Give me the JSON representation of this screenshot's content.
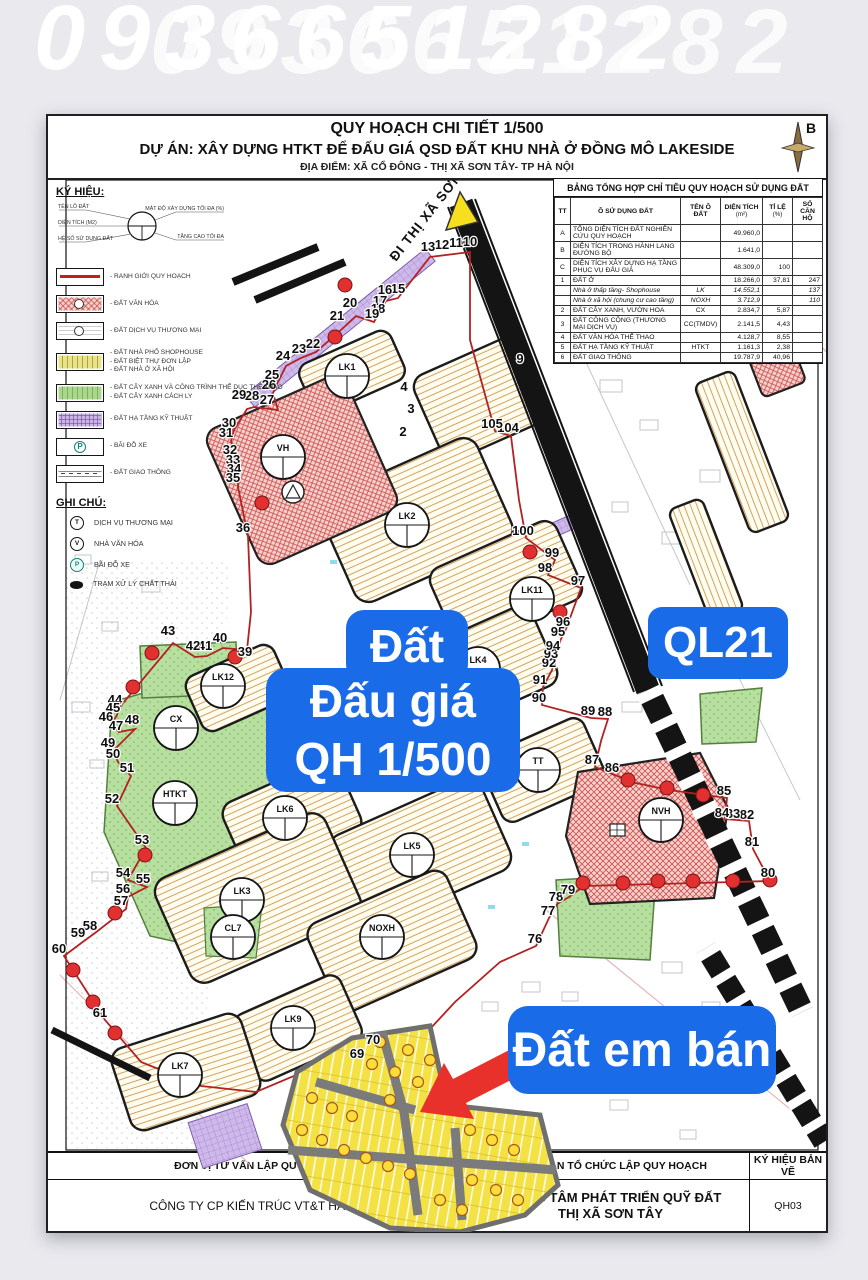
{
  "watermark": {
    "phone": "0936651282"
  },
  "header": {
    "line1": "QUY HOẠCH CHI TIẾT 1/500",
    "line2": "DỰ ÁN: XÂY DỰNG HTKT ĐỂ ĐẤU GIÁ QSD ĐẤT KHU NHÀ Ở ĐỒNG MÔ LAKESIDE",
    "line3": "ĐỊA ĐIỂM: XÃ CỔ ĐÔNG - THỊ XÃ SƠN TÂY- TP HÀ NỘI",
    "north_label": "B"
  },
  "legend": {
    "heading": "KÝ HIỆU:",
    "symbol_labels": [
      "TÊN LÔ ĐẤT",
      "DIỆN TÍCH (M2)",
      "HỆ SỐ SỬ DỤNG ĐẤT",
      "MẬT ĐỘ XÂY DỰNG TỐI ĐA (%)",
      "TẦNG CAO TỐI ĐA"
    ],
    "items": [
      {
        "type": "boundary",
        "labels": [
          "RANH GIỚI QUY HOẠCH"
        ]
      },
      {
        "type": "culture",
        "labels": [
          "ĐẤT VĂN HÓA"
        ]
      },
      {
        "type": "commerce",
        "labels": [
          "ĐẤT DỊCH VỤ THƯƠNG MẠI"
        ]
      },
      {
        "type": "housing",
        "labels": [
          "ĐẤT NHÀ PHỐ SHOPHOUSE",
          "ĐẤT BIỆT THỰ ĐƠN LẬP",
          "ĐẤT NHÀ Ở XÃ HỘI"
        ]
      },
      {
        "type": "green",
        "labels": [
          "ĐẤT CÂY XANH VÀ CÔNG TRÌNH THỂ DỤC THỂ THAO",
          "ĐẤT CÂY XANH CÁCH LY"
        ]
      },
      {
        "type": "infra",
        "labels": [
          "ĐẤT HẠ TẦNG KỸ THUẬT"
        ]
      },
      {
        "type": "parking",
        "labels": [
          "BÃI ĐỖ XE"
        ]
      },
      {
        "type": "traffic",
        "labels": [
          "ĐẤT GIAO THÔNG"
        ]
      }
    ],
    "notes_heading": "GHI CHÚ:",
    "notes": [
      {
        "icon": "commerce",
        "glyph": "T",
        "label": "DỊCH VỤ THƯƠNG MẠI"
      },
      {
        "icon": "culture",
        "glyph": "V",
        "label": "NHÀ VĂN HÓA"
      },
      {
        "icon": "parking",
        "glyph": "P",
        "label": "BÃI ĐỖ XE"
      },
      {
        "icon": "waste",
        "glyph": "",
        "label": "TRẠM XỬ LÝ CHẤT THẢI"
      }
    ]
  },
  "table": {
    "title": "BẢNG TỔNG HỢP CHỈ TIÊU QUY HOẠCH SỬ DỤNG ĐẤT",
    "columns": [
      {
        "l1": "TT"
      },
      {
        "l1": "Ô SỬ DỤNG ĐẤT"
      },
      {
        "l1": "TÊN Ô ĐẤT"
      },
      {
        "l1": "DIỆN TÍCH",
        "l2": "(m²)"
      },
      {
        "l1": "TỈ LỆ",
        "l2": "(%)"
      },
      {
        "l1": "SỐ CĂN HỘ"
      }
    ],
    "rows": [
      {
        "tt": "A",
        "name": "TỔNG DIỆN TÍCH ĐẤT NGHIÊN CỨU QUY HOẠCH",
        "code": "",
        "area": "49.960,0",
        "ratio": "",
        "units": ""
      },
      {
        "tt": "B",
        "name": "DIỆN TÍCH TRONG HÀNH LANG ĐƯỜNG BỘ",
        "code": "",
        "area": "1.641,0",
        "ratio": "",
        "units": ""
      },
      {
        "tt": "C",
        "name": "DIỆN TÍCH XÂY DỰNG HẠ TẦNG PHỤC VỤ ĐẤU GIÁ",
        "code": "",
        "area": "48.309,0",
        "ratio": "100",
        "units": ""
      },
      {
        "tt": "1",
        "name": "ĐẤT Ở",
        "code": "",
        "area": "18.266,0",
        "ratio": "37,81",
        "units": "247"
      },
      {
        "tt": "",
        "name": "Nhà ở thấp tầng- Shophouse",
        "code": "LK",
        "area": "14.552,1",
        "ratio": "",
        "units": "137",
        "italic": true
      },
      {
        "tt": "",
        "name": "Nhà ở xã hội (chung cư cao tầng)",
        "code": "NOXH",
        "area": "3.712,9",
        "ratio": "",
        "units": "110",
        "italic": true
      },
      {
        "tt": "2",
        "name": "ĐẤT CÂY XANH, VƯỜN HOA",
        "code": "CX",
        "area": "2.834,7",
        "ratio": "5,87",
        "units": ""
      },
      {
        "tt": "3",
        "name": "ĐẤT CÔNG CỘNG (THƯƠNG MẠI DỊCH VỤ)",
        "code": "CC(TMDV)",
        "area": "2.141,5",
        "ratio": "4,43",
        "units": ""
      },
      {
        "tt": "4",
        "name": "ĐẤT VĂN HÓA THỂ THAO",
        "code": "",
        "area": "4.128,7",
        "ratio": "8,55",
        "units": ""
      },
      {
        "tt": "5",
        "name": "ĐẤT HẠ TẦNG KỸ THUẬT",
        "code": "HTKT",
        "area": "1.161,3",
        "ratio": "2,38",
        "units": ""
      },
      {
        "tt": "6",
        "name": "ĐẤT GIAO THÔNG",
        "code": "",
        "area": "19.787,9",
        "ratio": "40,96",
        "units": ""
      }
    ]
  },
  "map": {
    "road_label": "ĐI THỊ XÃ SƠN TÂY",
    "overlays": {
      "auction_line1": "Đất",
      "auction_line2": "Đấu giá",
      "auction_line3": "QH 1/500",
      "highway": "QL21",
      "sale": "Đất em bán"
    },
    "boundary_points": [
      {
        "n": "2",
        "x": 403,
        "y": 436
      },
      {
        "n": "3",
        "x": 411,
        "y": 413
      },
      {
        "n": "4",
        "x": 404,
        "y": 391
      },
      {
        "n": "9",
        "x": 520,
        "y": 363
      },
      {
        "n": "10",
        "x": 470,
        "y": 246
      },
      {
        "n": "11",
        "x": 456,
        "y": 247
      },
      {
        "n": "12",
        "x": 442,
        "y": 249
      },
      {
        "n": "13",
        "x": 428,
        "y": 251
      },
      {
        "n": "15",
        "x": 398,
        "y": 293
      },
      {
        "n": "16",
        "x": 385,
        "y": 294
      },
      {
        "n": "17",
        "x": 380,
        "y": 305
      },
      {
        "n": "18",
        "x": 378,
        "y": 313
      },
      {
        "n": "19",
        "x": 372,
        "y": 318
      },
      {
        "n": "20",
        "x": 350,
        "y": 307
      },
      {
        "n": "21",
        "x": 337,
        "y": 320
      },
      {
        "n": "22",
        "x": 313,
        "y": 348
      },
      {
        "n": "23",
        "x": 299,
        "y": 353
      },
      {
        "n": "24",
        "x": 283,
        "y": 360
      },
      {
        "n": "25",
        "x": 272,
        "y": 379
      },
      {
        "n": "26",
        "x": 269,
        "y": 389
      },
      {
        "n": "27",
        "x": 267,
        "y": 404
      },
      {
        "n": "28",
        "x": 252,
        "y": 400
      },
      {
        "n": "29",
        "x": 239,
        "y": 399
      },
      {
        "n": "30",
        "x": 229,
        "y": 427
      },
      {
        "n": "31",
        "x": 226,
        "y": 437
      },
      {
        "n": "32",
        "x": 230,
        "y": 454
      },
      {
        "n": "33",
        "x": 233,
        "y": 464
      },
      {
        "n": "34",
        "x": 234,
        "y": 473
      },
      {
        "n": "35",
        "x": 233,
        "y": 482
      },
      {
        "n": "36",
        "x": 243,
        "y": 532
      },
      {
        "n": "39",
        "x": 245,
        "y": 656
      },
      {
        "n": "40",
        "x": 220,
        "y": 642
      },
      {
        "n": "41",
        "x": 205,
        "y": 650
      },
      {
        "n": "42",
        "x": 193,
        "y": 650
      },
      {
        "n": "43",
        "x": 168,
        "y": 635
      },
      {
        "n": "44",
        "x": 115,
        "y": 704
      },
      {
        "n": "45",
        "x": 113,
        "y": 712
      },
      {
        "n": "46",
        "x": 106,
        "y": 721
      },
      {
        "n": "47",
        "x": 116,
        "y": 730
      },
      {
        "n": "48",
        "x": 132,
        "y": 724
      },
      {
        "n": "49",
        "x": 108,
        "y": 747
      },
      {
        "n": "50",
        "x": 113,
        "y": 758
      },
      {
        "n": "51",
        "x": 127,
        "y": 772
      },
      {
        "n": "52",
        "x": 112,
        "y": 803
      },
      {
        "n": "53",
        "x": 142,
        "y": 844
      },
      {
        "n": "54",
        "x": 123,
        "y": 877
      },
      {
        "n": "55",
        "x": 143,
        "y": 883
      },
      {
        "n": "56",
        "x": 123,
        "y": 893
      },
      {
        "n": "57",
        "x": 121,
        "y": 905
      },
      {
        "n": "58",
        "x": 90,
        "y": 930
      },
      {
        "n": "59",
        "x": 78,
        "y": 937
      },
      {
        "n": "60",
        "x": 59,
        "y": 953
      },
      {
        "n": "61",
        "x": 100,
        "y": 1017
      },
      {
        "n": "69",
        "x": 357,
        "y": 1058
      },
      {
        "n": "70",
        "x": 373,
        "y": 1044
      },
      {
        "n": "76",
        "x": 535,
        "y": 943
      },
      {
        "n": "77",
        "x": 548,
        "y": 915
      },
      {
        "n": "78",
        "x": 556,
        "y": 901
      },
      {
        "n": "79",
        "x": 568,
        "y": 894
      },
      {
        "n": "80",
        "x": 768,
        "y": 877
      },
      {
        "n": "81",
        "x": 752,
        "y": 846
      },
      {
        "n": "82",
        "x": 747,
        "y": 819
      },
      {
        "n": "83",
        "x": 733,
        "y": 818
      },
      {
        "n": "84",
        "x": 722,
        "y": 817
      },
      {
        "n": "85",
        "x": 724,
        "y": 795
      },
      {
        "n": "86",
        "x": 612,
        "y": 772
      },
      {
        "n": "87",
        "x": 592,
        "y": 764
      },
      {
        "n": "88",
        "x": 605,
        "y": 716
      },
      {
        "n": "89",
        "x": 588,
        "y": 715
      },
      {
        "n": "90",
        "x": 539,
        "y": 702
      },
      {
        "n": "91",
        "x": 540,
        "y": 684
      },
      {
        "n": "92",
        "x": 549,
        "y": 667
      },
      {
        "n": "93",
        "x": 551,
        "y": 658
      },
      {
        "n": "94",
        "x": 553,
        "y": 650
      },
      {
        "n": "95",
        "x": 558,
        "y": 636
      },
      {
        "n": "96",
        "x": 563,
        "y": 626
      },
      {
        "n": "97",
        "x": 578,
        "y": 585
      },
      {
        "n": "98",
        "x": 545,
        "y": 572
      },
      {
        "n": "99",
        "x": 552,
        "y": 557
      },
      {
        "n": "100",
        "x": 523,
        "y": 535
      },
      {
        "n": "104",
        "x": 508,
        "y": 432
      },
      {
        "n": "105",
        "x": 492,
        "y": 428
      }
    ],
    "plot_labels": [
      {
        "label": "LK1",
        "x": 347,
        "y": 376
      },
      {
        "label": "VH",
        "x": 283,
        "y": 457
      },
      {
        "label": "LK2",
        "x": 407,
        "y": 525
      },
      {
        "label": "LK11",
        "x": 532,
        "y": 599
      },
      {
        "label": "LK4",
        "x": 478,
        "y": 669
      },
      {
        "label": "LK12",
        "x": 223,
        "y": 686
      },
      {
        "label": "CX",
        "x": 176,
        "y": 728
      },
      {
        "label": "HTKT",
        "x": 175,
        "y": 803
      },
      {
        "label": "LK6",
        "x": 285,
        "y": 818
      },
      {
        "label": "LK5",
        "x": 412,
        "y": 855
      },
      {
        "label": "TT",
        "x": 538,
        "y": 770
      },
      {
        "label": "LK3",
        "x": 242,
        "y": 900
      },
      {
        "label": "CL7",
        "x": 233,
        "y": 937
      },
      {
        "label": "NOXH",
        "x": 382,
        "y": 937
      },
      {
        "label": "LK9",
        "x": 293,
        "y": 1028
      },
      {
        "label": "LK7",
        "x": 180,
        "y": 1075
      },
      {
        "label": "NVH",
        "x": 661,
        "y": 820
      }
    ],
    "red_dots": [
      [
        345,
        285
      ],
      [
        335,
        337
      ],
      [
        262,
        503
      ],
      [
        152,
        653
      ],
      [
        235,
        657
      ],
      [
        133,
        687
      ],
      [
        145,
        855
      ],
      [
        115,
        913
      ],
      [
        73,
        970
      ],
      [
        93,
        1002
      ],
      [
        115,
        1033
      ],
      [
        583,
        883
      ],
      [
        623,
        883
      ],
      [
        658,
        881
      ],
      [
        693,
        881
      ],
      [
        733,
        881
      ],
      [
        628,
        780
      ],
      [
        667,
        788
      ],
      [
        703,
        795
      ],
      [
        530,
        552
      ],
      [
        560,
        612
      ],
      [
        770,
        880
      ]
    ],
    "sale_badges": [
      [
        372,
        1064
      ],
      [
        395,
        1072
      ],
      [
        408,
        1050
      ],
      [
        390,
        1100
      ],
      [
        418,
        1082
      ],
      [
        312,
        1098
      ],
      [
        332,
        1108
      ],
      [
        352,
        1116
      ],
      [
        302,
        1130
      ],
      [
        322,
        1140
      ],
      [
        344,
        1150
      ],
      [
        366,
        1158
      ],
      [
        388,
        1166
      ],
      [
        410,
        1174
      ],
      [
        470,
        1130
      ],
      [
        492,
        1140
      ],
      [
        514,
        1150
      ],
      [
        472,
        1180
      ],
      [
        496,
        1190
      ],
      [
        518,
        1200
      ],
      [
        440,
        1200
      ],
      [
        462,
        1210
      ],
      [
        430,
        1060
      ],
      [
        380,
        1042
      ]
    ]
  },
  "titleblock": {
    "col1_header": "ĐƠN VỊ TƯ VẤN LẬP QUY HOẠCH",
    "col1_value": "CÔNG TY CP KIẾN TRÚC VT&T HÀ NỘI",
    "col2_header": "CƠ QUAN TỔ CHỨC LẬP QUY HOẠCH",
    "col2_value_line1": "TRUNG TÂM PHÁT TRIỂN QUỸ ĐẤT",
    "col2_value_line2": "THỊ XÃ SƠN TÂY",
    "col3_header": "KÝ HIỆU BẢN VẼ",
    "col3_value": "QH03"
  }
}
